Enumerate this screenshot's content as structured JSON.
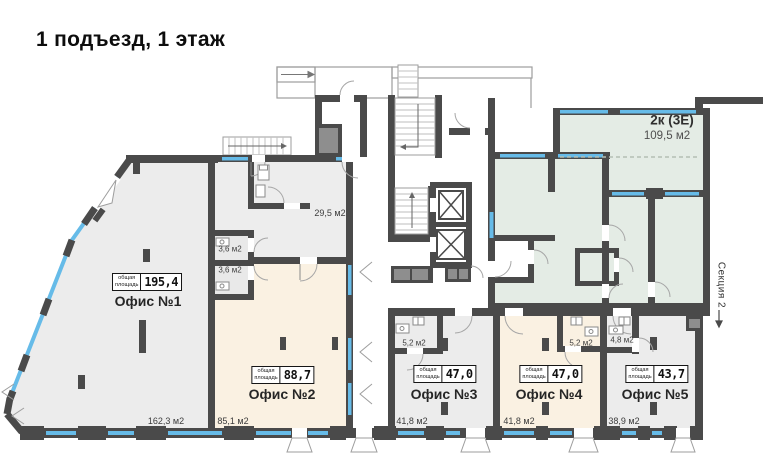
{
  "title": "1 подъезд, 1 этаж",
  "section_label": "Секция 2",
  "stamp_caption": {
    "line1": "общая",
    "line2": "площадь"
  },
  "apartment": {
    "name": "2к (3Е)",
    "area": "109,5 м2"
  },
  "offices": [
    {
      "name": "Офис №1",
      "total": "195,4",
      "main_area": "162,3 м2"
    },
    {
      "name": "Офис №2",
      "total": "88,7",
      "main_area": "85,1 м2"
    },
    {
      "name": "Офис №3",
      "total": "47,0",
      "main_area": "41,8 м2",
      "wc_area": "5,2 м2"
    },
    {
      "name": "Офис №4",
      "total": "47,0",
      "main_area": "41,8 м2",
      "wc_area": "5,2 м2"
    },
    {
      "name": "Офис №5",
      "total": "43,7",
      "main_area": "38,9 м2",
      "wc_area": "4,8 м2"
    }
  ],
  "service_rooms": {
    "vestibule_area": "29,5 м2",
    "wc_a": "3,6 м2",
    "wc_b": "3,6 м2"
  },
  "colors": {
    "wall": "#4a4a4a",
    "office_fill": "#ececec",
    "commercial_fill": "#faf1e2",
    "apartment_fill": "#e4ece5",
    "window": "#66bbe8",
    "shaft_fill": "#8e8e8e",
    "outline": "#9d9d9d"
  },
  "icons": {
    "stairs": "hatched-steps",
    "elevator": "crossed-box",
    "door": "quarter-arc-swing",
    "window_vent": "chevron-mark"
  }
}
